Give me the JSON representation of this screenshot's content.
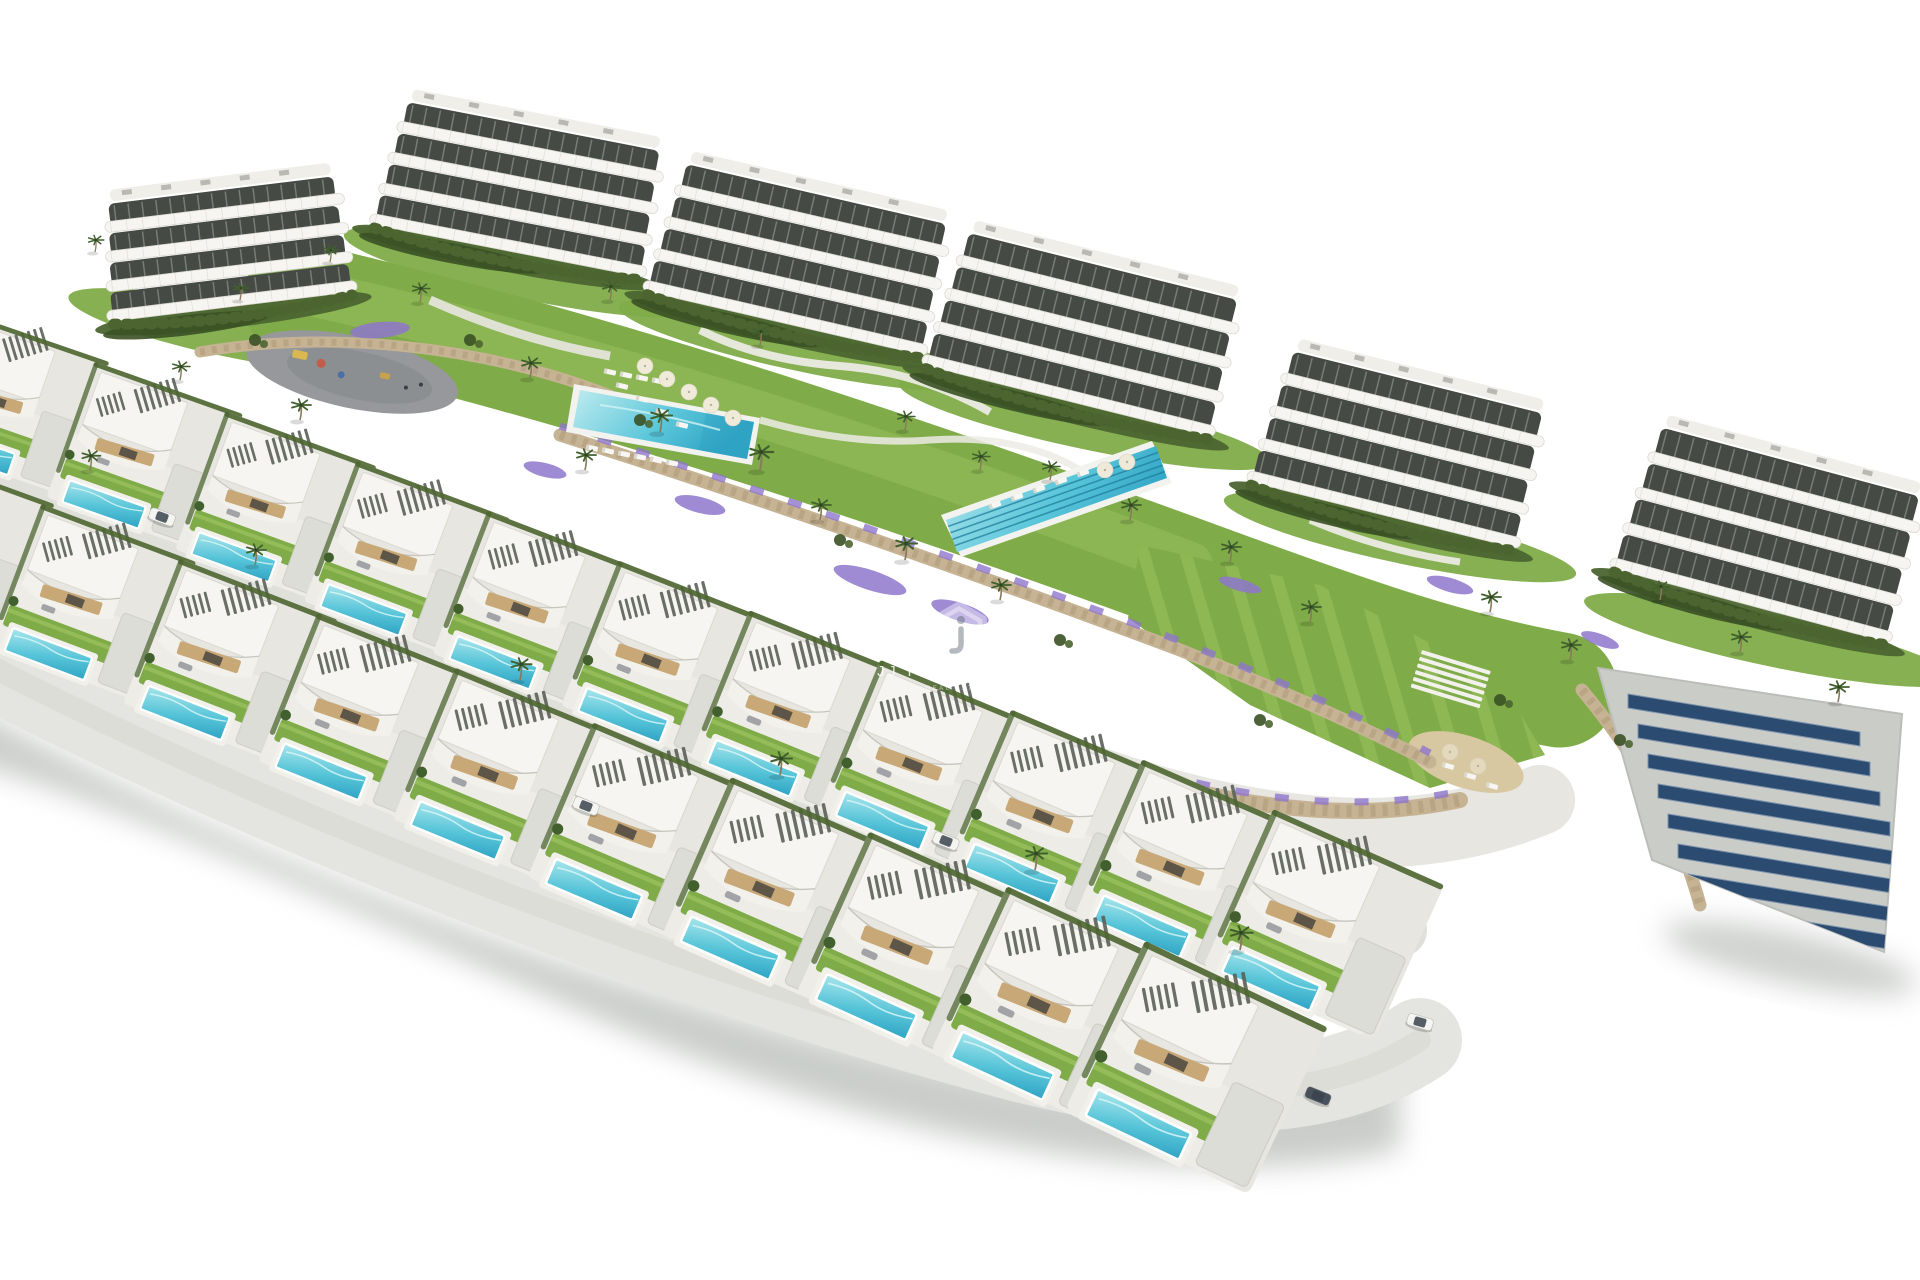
{
  "watermark": {
    "title": "JJ PROPERTIES",
    "tagline": "REAL ESTATE",
    "icon": "jj-hexagon-monogram"
  },
  "scene": {
    "description": "Aerial 3D architectural render of a hillside residential development: a back row of curved white apartment buildings, communal gardens with two shared swimming pools, and two front rows of modern villas each with a private turquoise pool, on a white background",
    "apartment_buildings": 6,
    "apartment_floors": 4,
    "villas_upper_row": 11,
    "villas_lower_row": 10,
    "communal_pools": 2,
    "lap_pool_lanes": 4,
    "solar_panel_rows": 8,
    "cars_visible": 5,
    "playgrounds": 1
  },
  "colors": {
    "background": "#FFFFFF",
    "pool_water": "#4FC0D6",
    "pool_water_deep": "#2FA3C4",
    "pool_water_light": "#A9E6EC",
    "lawn": "#7FAC49",
    "lawn_light": "#9DC360",
    "hedge": "#4C6530",
    "hedge_dark": "#3A5125",
    "stone_wall": "#C6B394",
    "stone_joint": "#A8946F",
    "paving": "#E3E3DE",
    "paving_dark": "#CFCFC9",
    "plaza": "#96989B",
    "roof_white": "#F6F5F1",
    "band_edge": "#DBD9D1",
    "slat_dark": "#5A5F58",
    "facade_tan": "#C8A876",
    "glass_dark": "#454A44",
    "solar_panel": "#2C4B70",
    "sand": "#D8C8A2",
    "flowers_purple": "#8E75CC",
    "palm_frond": "#41602E",
    "trunk": "#8A7A5C",
    "car_white": "#F4F4F1",
    "car_dark": "#49525C",
    "shadow": "#9FA49F",
    "watermark_white": "#FFFFFF"
  }
}
